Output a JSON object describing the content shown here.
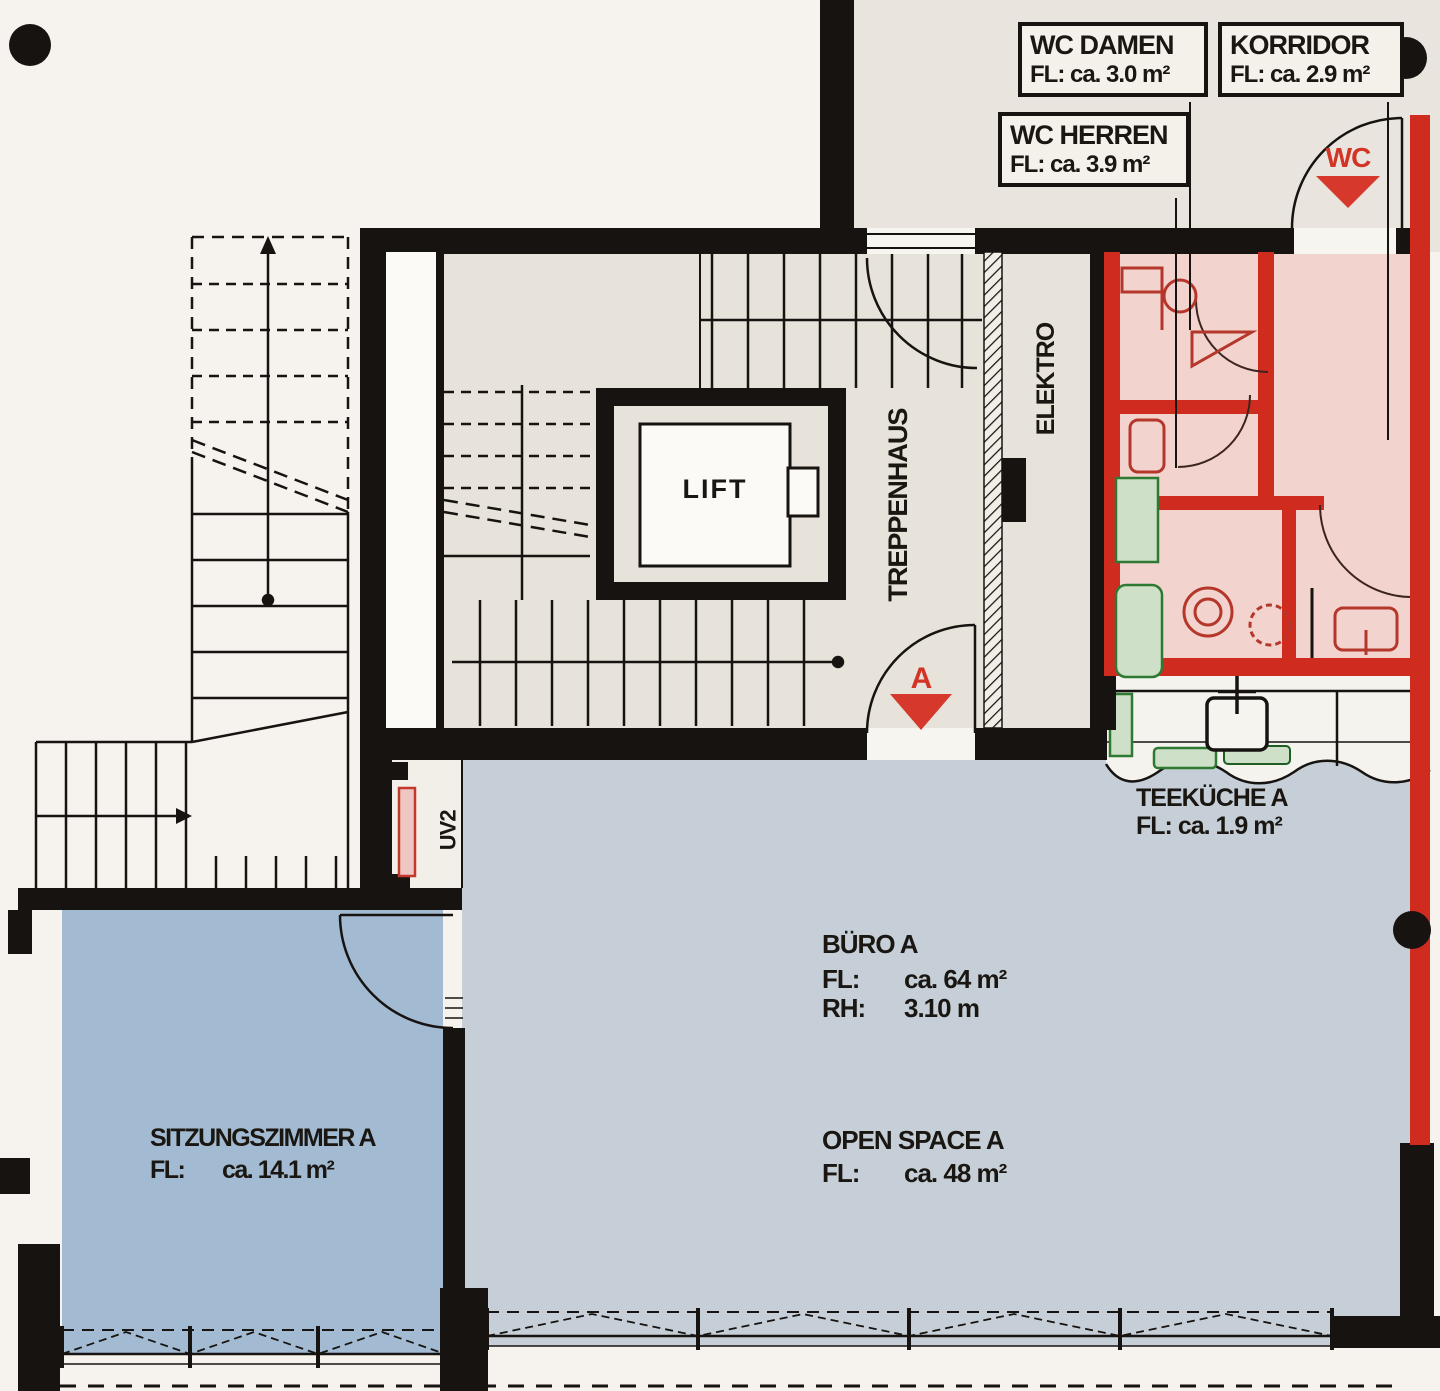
{
  "plan_title": "Grundriss Büro A",
  "colors": {
    "wall_black": "#171310",
    "new_wall_red": "#cf2b1f",
    "accent_red": "#d23425",
    "open_space_blue": "#c6cfd8",
    "sitzungszimmer_blue": "#a3bbd2",
    "wc_zone_pink": "#f2d3ce",
    "corridor_grey": "#e9e5de",
    "fixture_green": "#2f7a33",
    "paper": "#f6f3ee"
  },
  "labels": {
    "wc_damen_line1": "WC DAMEN",
    "wc_damen_line2": "FL: ca. 3.0 m²",
    "korridor_line1": "KORRIDOR",
    "korridor_line2": "FL: ca. 2.9 m²",
    "wc_herren_line1": "WC HERREN",
    "wc_herren_line2": "FL: ca. 3.9 m²",
    "teekueche_line1": "TEEKÜCHE A",
    "teekueche_line2": "FL: ca. 1.9 m²",
    "buero_name": "BÜRO A",
    "buero_fl_key": "FL:",
    "buero_fl_val": "ca. 64 m²",
    "buero_rh_key": "RH:",
    "buero_rh_val": "3.10 m",
    "openspace_name": "OPEN SPACE A",
    "openspace_fl_key": "FL:",
    "openspace_fl_val": "ca. 48 m²",
    "sitz_name": "SITZUNGSZIMMER A",
    "sitz_fl_key": "FL:",
    "sitz_fl_val": "ca. 14.1 m²",
    "lift": "LIFT",
    "treppenhaus": "TREPPENHAUS",
    "elektro": "ELEKTRO",
    "uv2": "UV2",
    "arrow_wc": "WC",
    "arrow_a": "A"
  }
}
